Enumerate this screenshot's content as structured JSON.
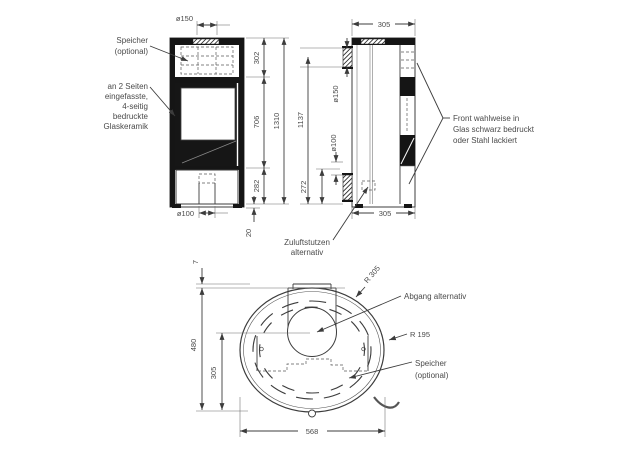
{
  "title": "Kaminofen Maßzeichnung",
  "colors": {
    "line": "#3c3c3c",
    "dark_fill": "#151515",
    "background": "#ffffff",
    "text": "#4a4a4a"
  },
  "front": {
    "dims": {
      "flue_d": "ø150",
      "upper": "302",
      "glass": "706",
      "total": "1310",
      "base": "282",
      "feet": "20",
      "inlet_d": "ø100"
    },
    "labels": {
      "speicher": [
        "Speicher",
        "(optional)"
      ],
      "glass": [
        "an 2 Seiten",
        "eingefasste,",
        "4-seitig",
        "bedruckte",
        "Glaskeramik"
      ]
    }
  },
  "side": {
    "dims": {
      "depth_top": "305",
      "flue_d": "ø150",
      "height_flue": "1137",
      "inlet_d": "ø100",
      "inlet_h": "272",
      "depth_bottom": "305"
    },
    "labels": {
      "front_finish": [
        "Front wahlweise in",
        "Glas schwarz bedruckt",
        "oder Stahl lackiert"
      ],
      "zuluft": [
        "Zuluftstutzen",
        "alternativ"
      ]
    }
  },
  "top": {
    "dims": {
      "gap": "7",
      "depth": "480",
      "center": "305",
      "width": "568",
      "r_outer": "R 305",
      "r_inner": "R 195"
    },
    "labels": {
      "abgang": "Abgang alternativ",
      "speicher": [
        "Speicher",
        "(optional)"
      ]
    }
  }
}
